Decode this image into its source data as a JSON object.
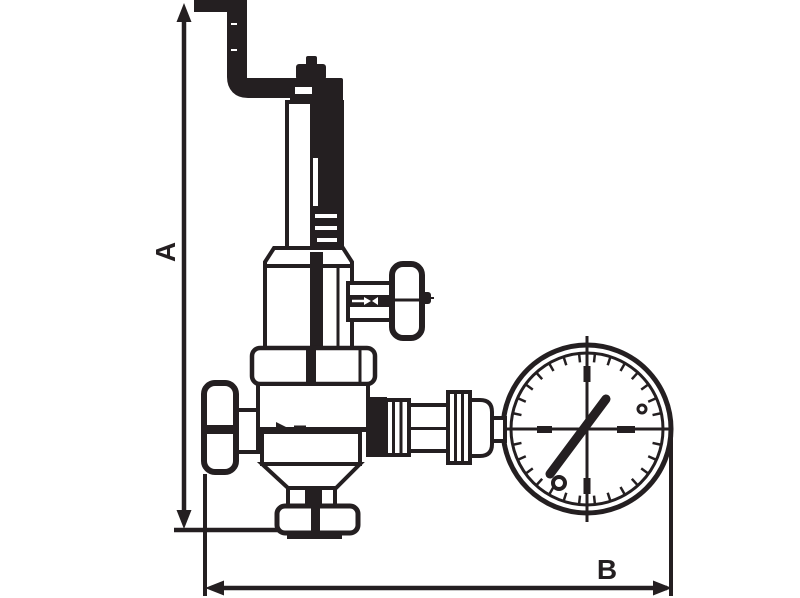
{
  "diagram": {
    "type": "technical-dimension-drawing",
    "description": "Line drawing of a safety/pressure-reducing valve with top discharge pipe, spring housing, T-handle side tap, shut-off knob and pressure gauge",
    "colors": {
      "line": "#241f21",
      "background": "#ffffff"
    },
    "labels": {
      "dim_vertical": "A",
      "dim_horizontal": "B"
    },
    "gauge": {
      "cx": 587,
      "cy": 429,
      "r_outer": 84,
      "r_inner": 76,
      "tick_outer": 75,
      "tick_inner": 67,
      "tick_count": 30
    }
  }
}
